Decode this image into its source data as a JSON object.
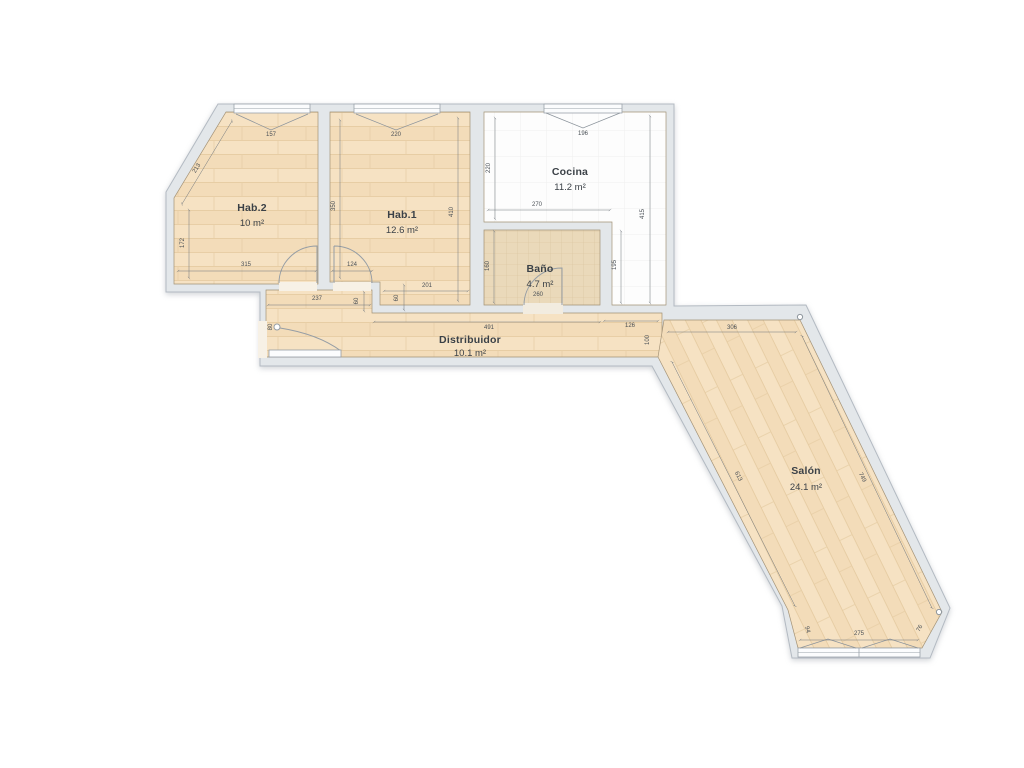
{
  "plan_type": "floor-plan",
  "rooms": {
    "hab2": {
      "name": "Hab.2",
      "area": "10 m²"
    },
    "hab1": {
      "name": "Hab.1",
      "area": "12.6 m²"
    },
    "cocina": {
      "name": "Cocina",
      "area": "11.2 m²"
    },
    "bano": {
      "name": "Baño",
      "area": "4.7 m²"
    },
    "distribuidor": {
      "name": "Distribuidor",
      "area": "10.1 m²"
    },
    "salon": {
      "name": "Salón",
      "area": "24.1 m²"
    }
  },
  "dims": {
    "hab2_window": "157",
    "hab2_diag": "213",
    "hab2_left": "172",
    "hab2_bottom": "315",
    "hab1_window": "220",
    "hab1_left": "350",
    "hab1_right": "410",
    "hab1_door": "124",
    "hab1_step": "60",
    "hab1_bottom": "201",
    "cocina_window": "196",
    "cocina_left": "220",
    "cocina_width": "270",
    "cocina_right": "415",
    "cocina_inner": "195",
    "bano_left": "160",
    "bano_width": "260",
    "dist_width": "237",
    "dist_step": "60",
    "dist_entry": "80",
    "dist_main": "491",
    "dist_right": "126",
    "dist_right_h": "100",
    "salon_top": "306",
    "salon_left": "613",
    "salon_right": "749",
    "salon_cut_l": "94",
    "salon_window": "275",
    "salon_cut_r": "76"
  },
  "colors": {
    "wood": "#f5dfc0",
    "wall": "#e3e7ea",
    "tile": "#e9dabd",
    "kitchen_floor": "#ffffff",
    "text": "#3b4147",
    "dim_text": "#4a5056"
  }
}
